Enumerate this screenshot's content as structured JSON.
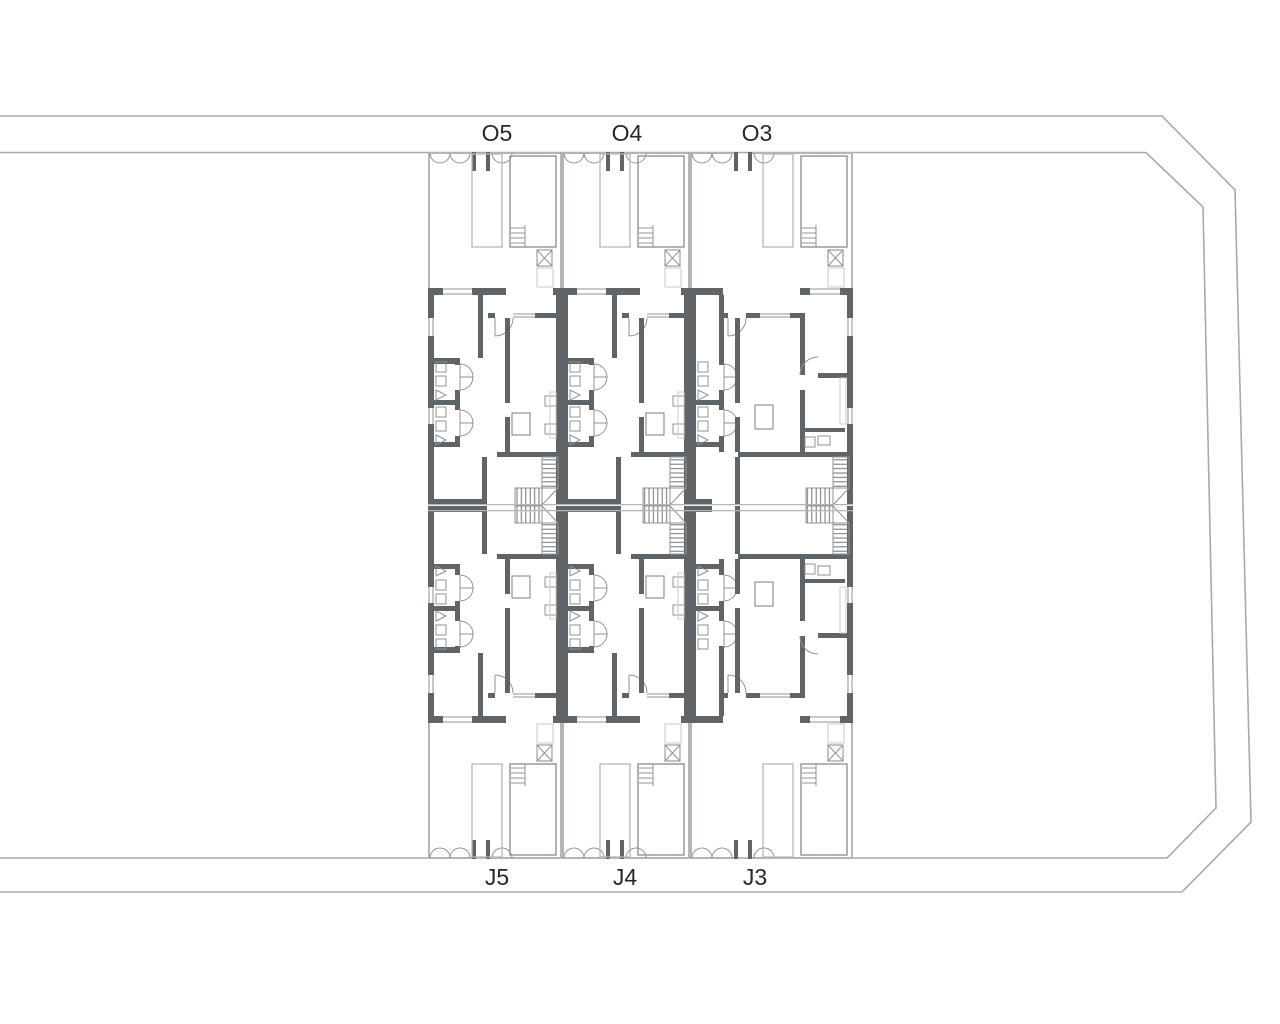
{
  "labels": {
    "top": [
      "O5",
      "O4",
      "O3"
    ],
    "bottom": [
      "J5",
      "J4",
      "J3"
    ]
  },
  "colors": {
    "background": "#ffffff",
    "boundary": "#a7aaac",
    "wall": "#5f6468",
    "light": "#b3b6b8",
    "thin": "#8f9396",
    "faint": "#ccced0",
    "hatch": "#6f7376",
    "band": "#b3b6b8",
    "label": "#26282b"
  }
}
